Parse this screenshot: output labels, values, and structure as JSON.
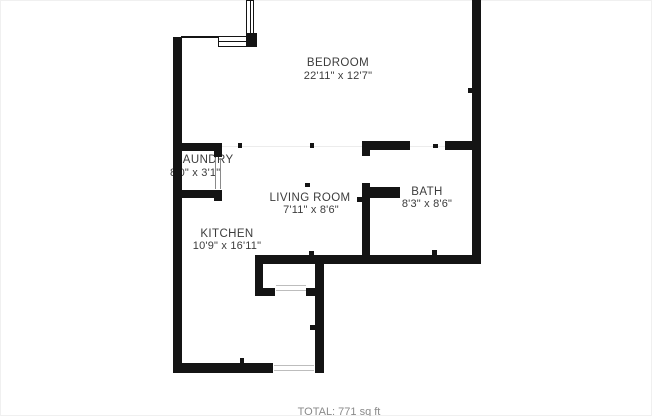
{
  "colors": {
    "background": "#ffffff",
    "wall": "#141414",
    "label": "#3c3c3c"
  },
  "floorplan": {
    "rooms": [
      {
        "id": "bedroom",
        "name": "BEDROOM",
        "dimensions": "22'11\" x 12'7\""
      },
      {
        "id": "laundry",
        "name": "LAUNDRY",
        "dimensions": "8'0\" x 3'1\""
      },
      {
        "id": "living-room",
        "name": "LIVING ROOM",
        "dimensions": "7'11\" x 8'6\""
      },
      {
        "id": "bath",
        "name": "BATH",
        "dimensions": "8'3\" x 8'6\""
      },
      {
        "id": "kitchen",
        "name": "KITCHEN",
        "dimensions": "10'9\" x 16'11\""
      }
    ],
    "footer": "TOTAL: 771 sq ft"
  }
}
